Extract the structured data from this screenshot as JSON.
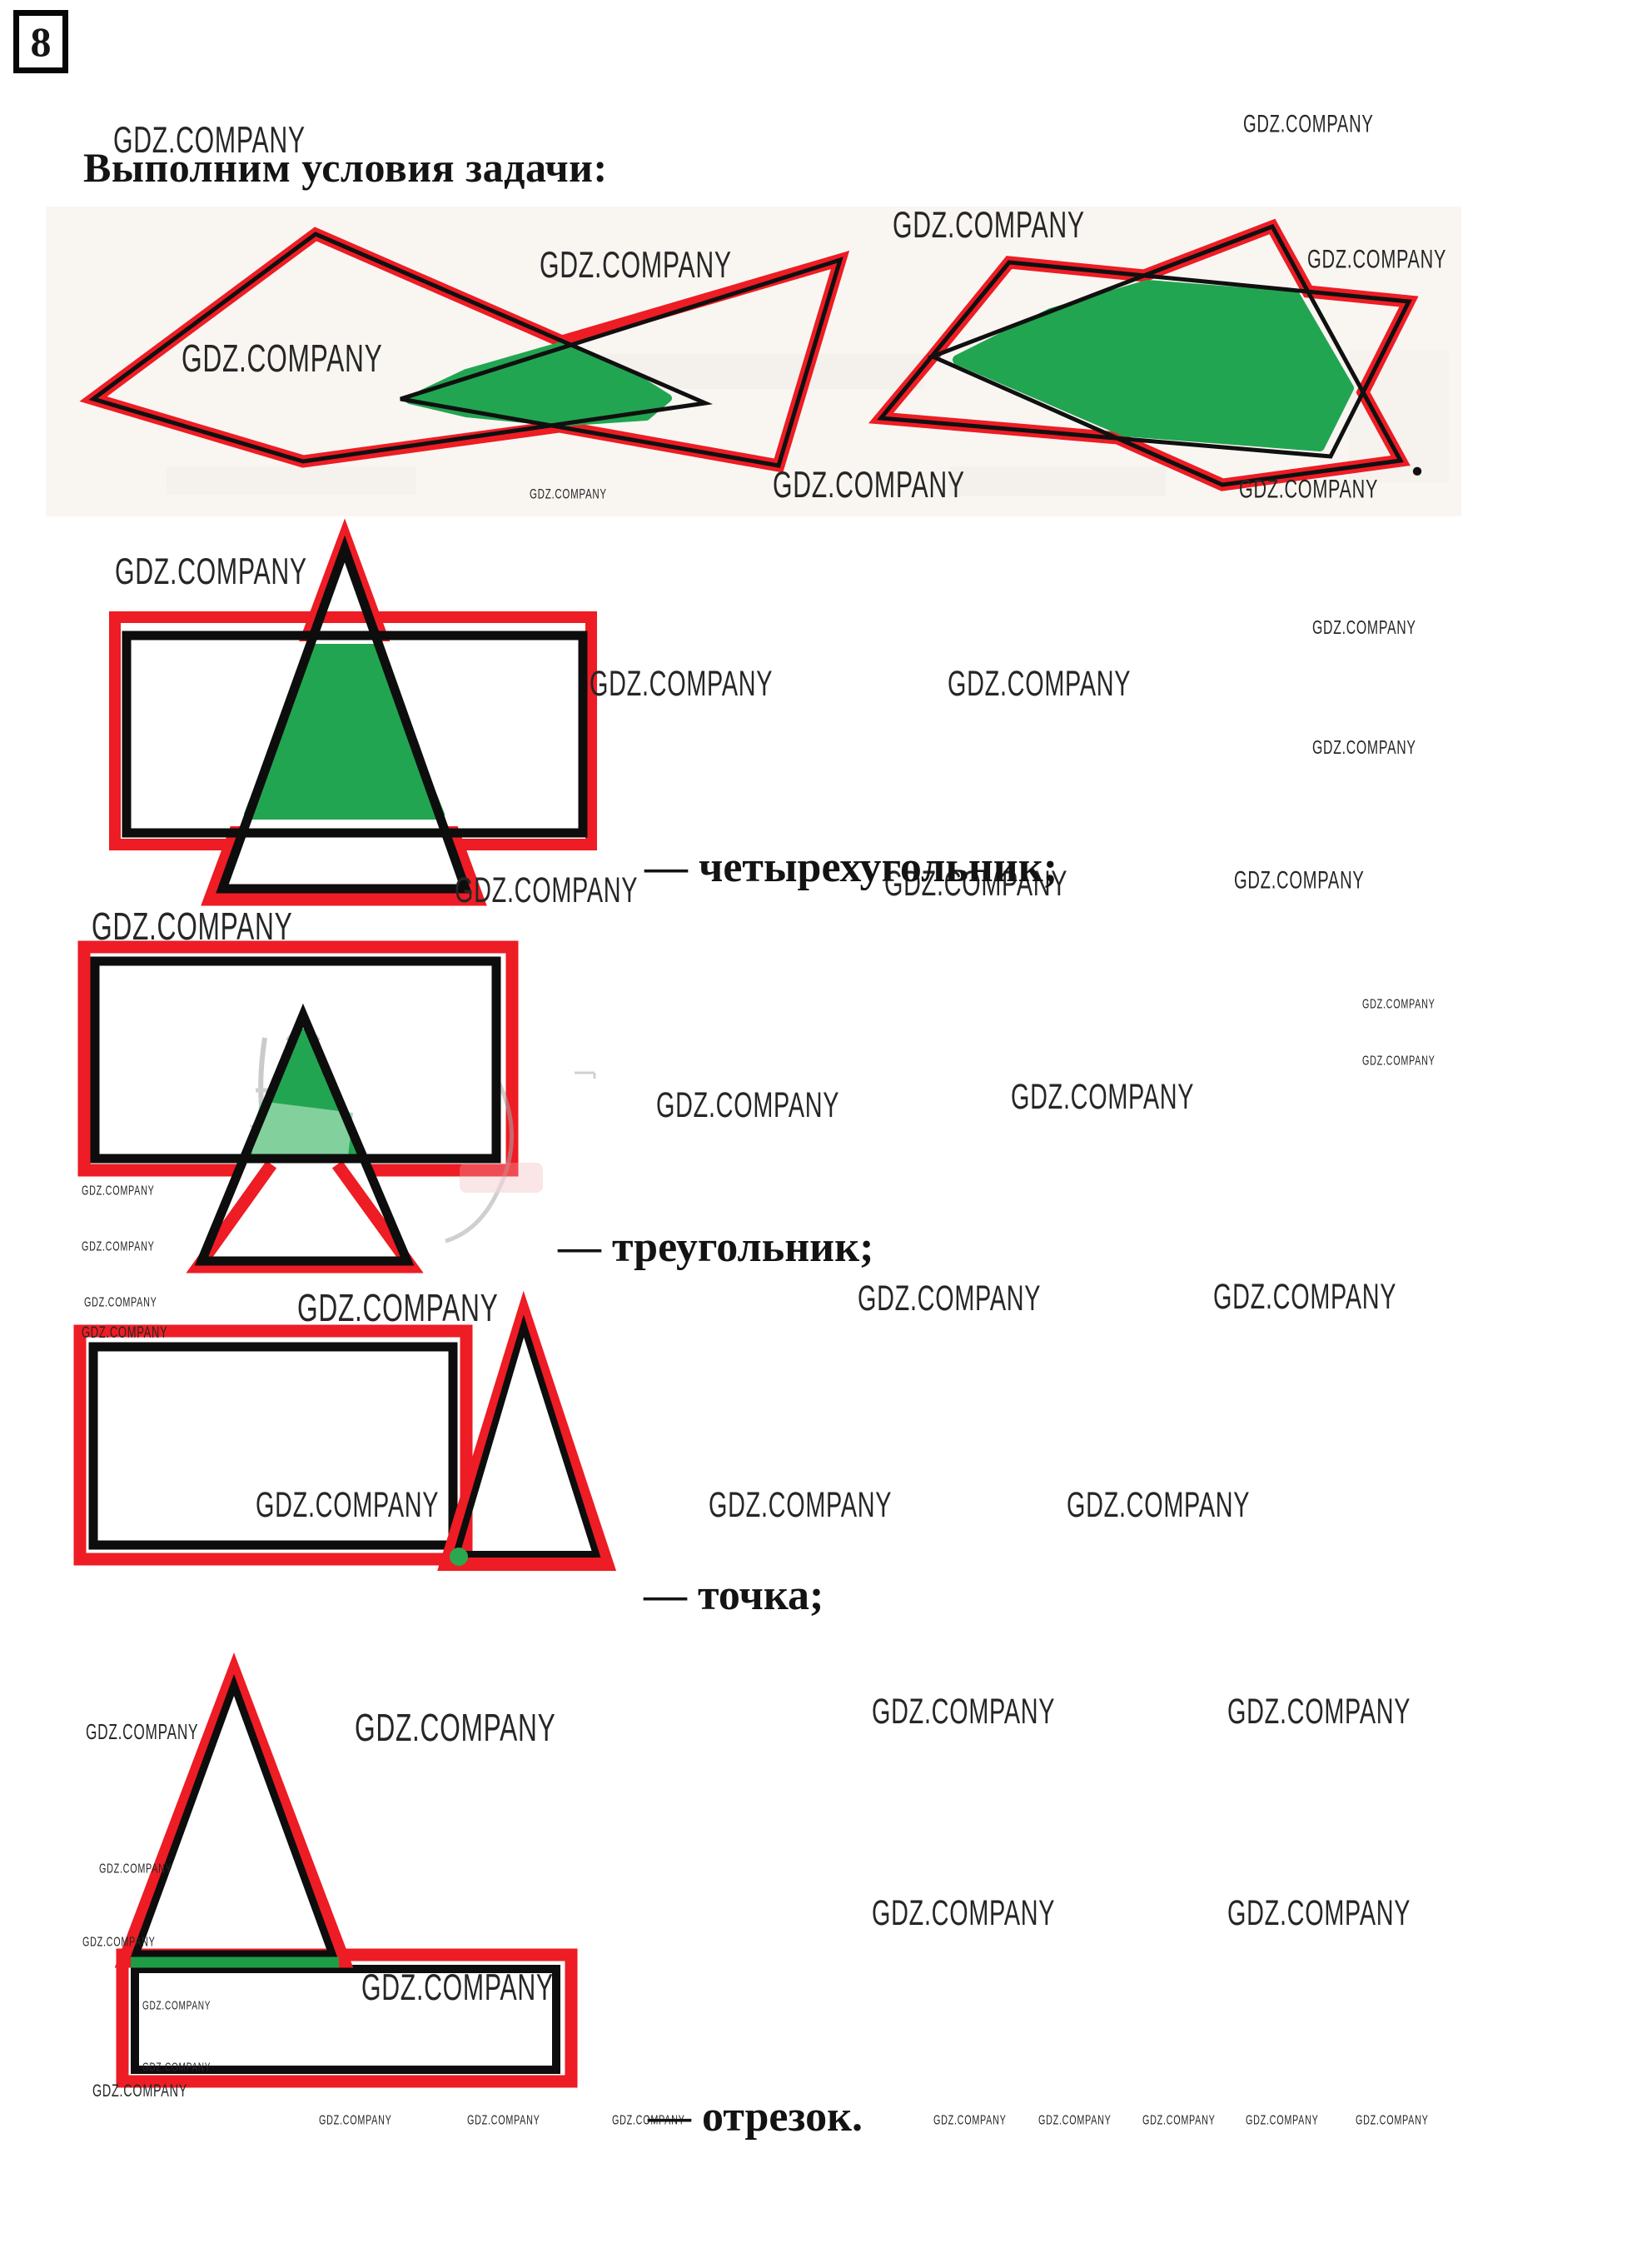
{
  "page": {
    "number": "8",
    "title": "Выполним условия задачи:",
    "period_after_figures": "."
  },
  "sections": [
    {
      "id": "quadrilateral",
      "label": "— четырехугольник;"
    },
    {
      "id": "triangle",
      "label": "— треугольник;"
    },
    {
      "id": "point",
      "label": "— точка;"
    },
    {
      "id": "segment",
      "label": "— отрезок."
    }
  ],
  "watermark": {
    "label": "GDZ.COMPANY",
    "positions": [
      [
        136,
        146,
        42
      ],
      [
        1493,
        134,
        28
      ],
      [
        648,
        296,
        42
      ],
      [
        218,
        408,
        44
      ],
      [
        1072,
        248,
        42
      ],
      [
        1570,
        296,
        30
      ],
      [
        928,
        560,
        42
      ],
      [
        636,
        586,
        16
      ],
      [
        1488,
        572,
        30
      ],
      [
        138,
        664,
        42
      ],
      [
        1576,
        742,
        22
      ],
      [
        1576,
        886,
        22
      ],
      [
        708,
        800,
        40
      ],
      [
        1138,
        800,
        40
      ],
      [
        110,
        1090,
        44
      ],
      [
        546,
        1048,
        40
      ],
      [
        1062,
        1040,
        40
      ],
      [
        1482,
        1042,
        28
      ],
      [
        788,
        1306,
        40
      ],
      [
        1214,
        1296,
        40
      ],
      [
        1636,
        1198,
        15
      ],
      [
        1636,
        1266,
        15
      ],
      [
        98,
        1422,
        15
      ],
      [
        98,
        1489,
        15
      ],
      [
        101,
        1556,
        15
      ],
      [
        357,
        1548,
        44
      ],
      [
        98,
        1590,
        18
      ],
      [
        1030,
        1538,
        40
      ],
      [
        1457,
        1536,
        40
      ],
      [
        307,
        1786,
        40
      ],
      [
        851,
        1786,
        40
      ],
      [
        1281,
        1786,
        40
      ],
      [
        103,
        2068,
        24
      ],
      [
        426,
        2052,
        44
      ],
      [
        1047,
        2034,
        40
      ],
      [
        1474,
        2034,
        40
      ],
      [
        119,
        2236,
        15
      ],
      [
        99,
        2324,
        15
      ],
      [
        434,
        2364,
        42
      ],
      [
        171,
        2400,
        14
      ],
      [
        171,
        2474,
        14
      ],
      [
        1047,
        2276,
        40
      ],
      [
        1474,
        2276,
        40
      ],
      [
        111,
        2500,
        20
      ],
      [
        383,
        2538,
        15
      ],
      [
        561,
        2538,
        15
      ],
      [
        735,
        2538,
        15
      ],
      [
        1121,
        2538,
        15
      ],
      [
        1247,
        2538,
        15
      ],
      [
        1372,
        2538,
        15
      ],
      [
        1496,
        2538,
        15
      ],
      [
        1628,
        2538,
        15
      ]
    ]
  },
  "colors": {
    "marker_red": "#ee1c24",
    "fill_green": "#22a551",
    "segment_green": "#1f9c46",
    "line_black": "#101010",
    "scan_tint": "#f9f6f2"
  }
}
